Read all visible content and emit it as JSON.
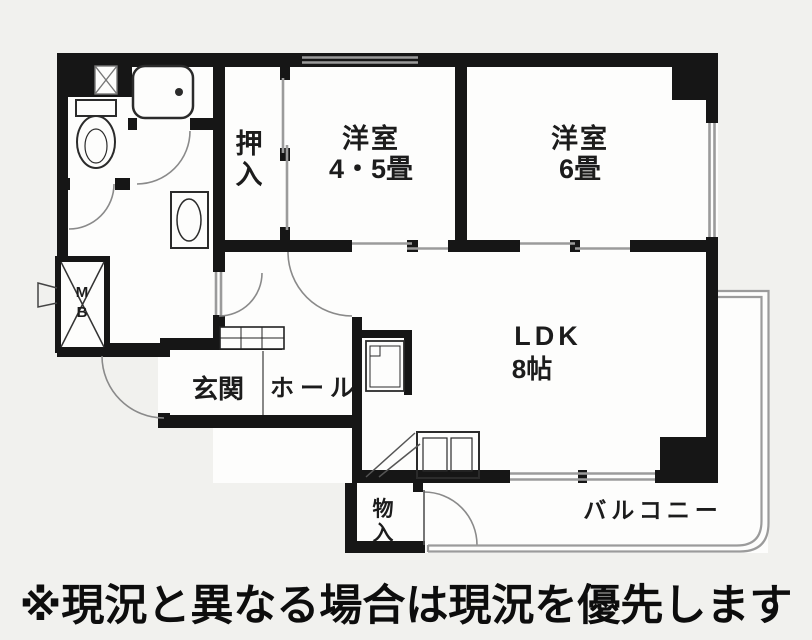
{
  "colors": {
    "background": "#f1f1ee",
    "room_fill": "#fdfdfc",
    "wall": "#161616",
    "opening_gray": "#9b9b9b",
    "arc_gray": "#8a8a8a",
    "fixture": "#2b2b2b",
    "text": "#1c1c1c"
  },
  "plan": {
    "room_labels": {
      "western_45": {
        "name": "洋室",
        "size": "4・5畳"
      },
      "western_6": {
        "name": "洋室",
        "size": "6畳"
      },
      "ldk": {
        "name": "LDK",
        "size": "8帖"
      },
      "closet": {
        "char1": "押",
        "char2": "入"
      },
      "entrance": "玄関",
      "hall": "ホール",
      "storage": {
        "char1": "物",
        "char2": "入"
      },
      "balcony": "バルコニー",
      "meter_box": {
        "char1": "M",
        "char2": "B"
      }
    }
  },
  "disclaimer": "※現況と異なる場合は現況を優先します"
}
